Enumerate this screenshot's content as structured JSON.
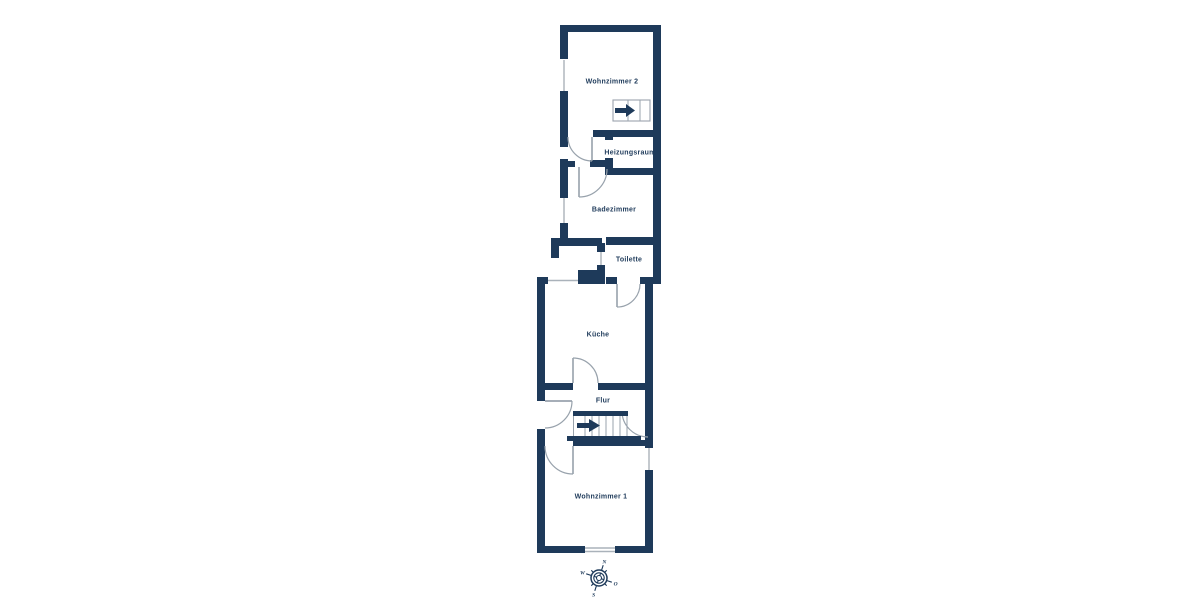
{
  "palette": {
    "wall": "#1e3a5a",
    "background": "#ffffff",
    "door_arc": "#98a2ac",
    "window_line": "#aab2ba",
    "label_text": "#1e3a5a"
  },
  "floorplan": {
    "rooms": [
      {
        "id": "wohnzimmer-2",
        "label": "Wohnzimmer 2"
      },
      {
        "id": "heizungsraum",
        "label": "Heizungsraum"
      },
      {
        "id": "badezimmer",
        "label": "Badezimmer"
      },
      {
        "id": "toilette",
        "label": "Toilette"
      },
      {
        "id": "kueche",
        "label": "Küche"
      },
      {
        "id": "flur",
        "label": "Flur"
      },
      {
        "id": "wohnzimmer-1",
        "label": "Wohnzimmer 1"
      }
    ],
    "stairs": [
      {
        "room": "Wohnzimmer 2",
        "arrow_direction": "right"
      },
      {
        "room": "Flur",
        "arrow_direction": "right"
      }
    ]
  },
  "compass": {
    "north": "N",
    "east": "O",
    "south": "S",
    "west": "W",
    "rotation_deg": 18
  }
}
